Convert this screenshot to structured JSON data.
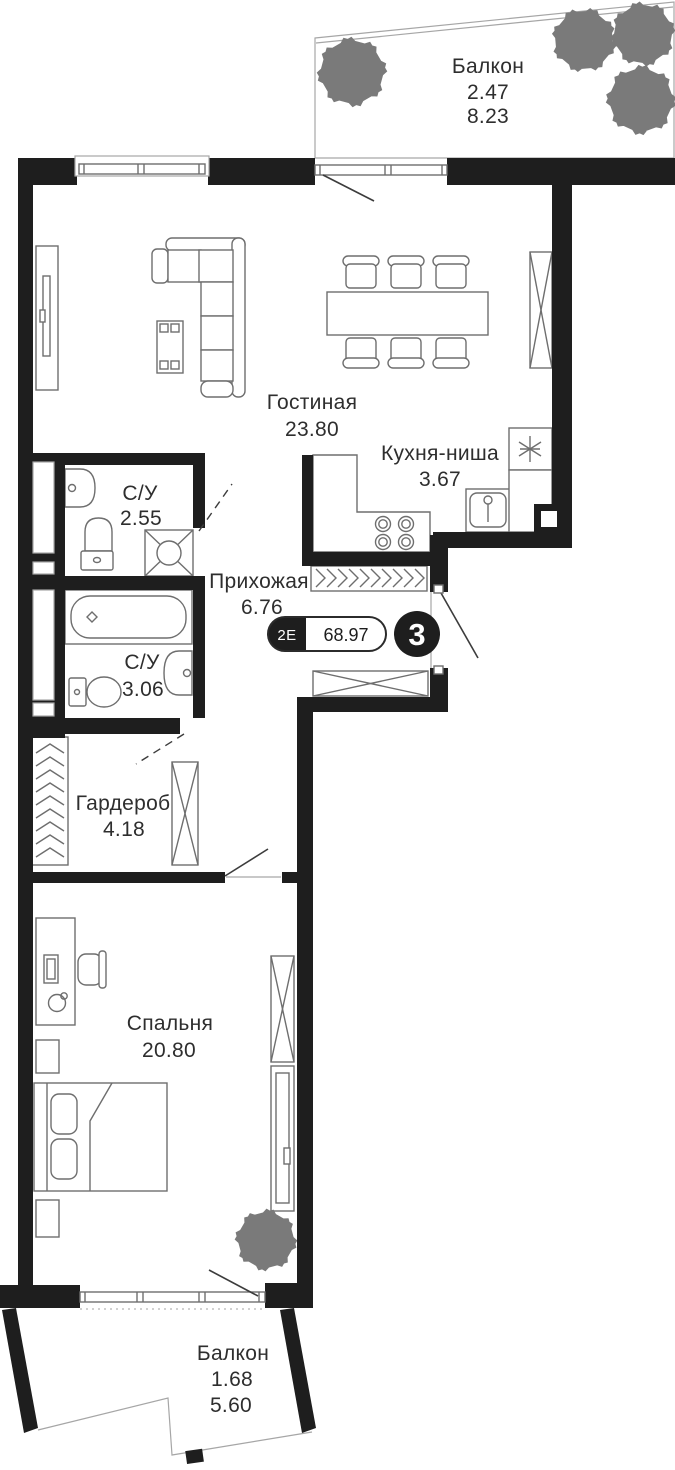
{
  "floor_plan": {
    "unit_badge": {
      "layout_label": "2Е",
      "total_area": "68.97",
      "unit_number": "3"
    },
    "rooms": {
      "balcony_top": {
        "name": "Балкон",
        "area_coeff": "2.47",
        "area_full": "8.23"
      },
      "living_room": {
        "name": "Гостиная",
        "area": "23.80"
      },
      "kitchen_niche": {
        "name": "Кухня-ниша",
        "area": "3.67"
      },
      "bathroom_small": {
        "name": "С/У",
        "area": "2.55"
      },
      "hallway": {
        "name": "Прихожая",
        "area": "6.76"
      },
      "bathroom_large": {
        "name": "С/У",
        "area": "3.06"
      },
      "wardrobe": {
        "name": "Гардероб",
        "area": "4.18"
      },
      "bedroom": {
        "name": "Спальня",
        "area": "20.80"
      },
      "balcony_bottom": {
        "name": "Балкон",
        "area_coeff": "1.68",
        "area_full": "5.60"
      }
    },
    "colors": {
      "wall": "#1e1e1e",
      "line": "#6e6e6e",
      "text": "#2e2e2e",
      "bg": "#ffffff"
    }
  }
}
